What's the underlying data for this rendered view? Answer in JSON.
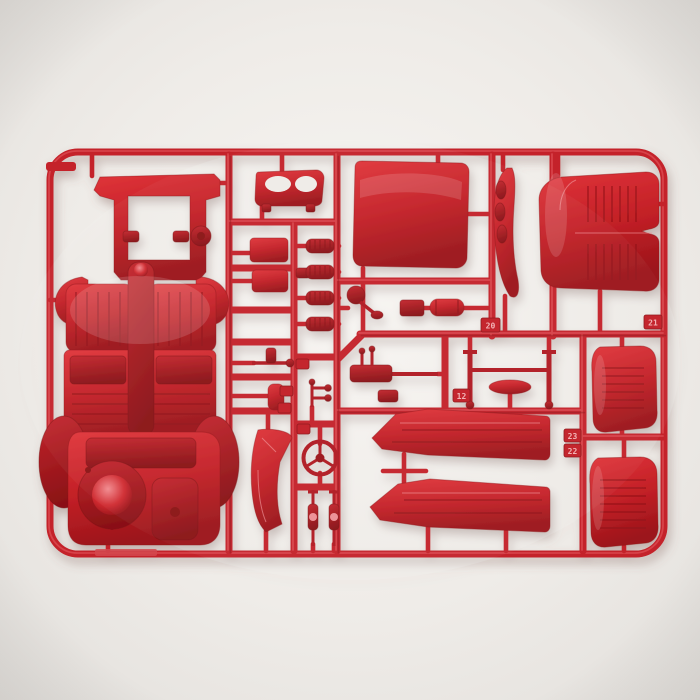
{
  "scene": {
    "type": "photograph",
    "subject": "Red plastic model-kit sprue (parts runner) with car model parts",
    "background_color": "#eae7e3",
    "plastic_color": "#c4222a",
    "plastic_dark": "#8e1217",
    "plastic_highlight": "#ef8e92"
  },
  "tags": {
    "t20": "20",
    "t21": "21",
    "t12": "12",
    "t23": "23",
    "t22": "22"
  },
  "parts": {
    "chassis": "chassis floor pan with seats and spare-wheel well",
    "dashboard": "dashboard panel with two oval recesses",
    "roof_panel": "large square roof panel",
    "window_rail": "curved window rail",
    "bench_seat": "rear bench seat",
    "small_box_1": "small rectangular box",
    "small_box_2": "small rectangular box",
    "springs": "four coil springs",
    "mirror": "mirror with arm",
    "muffler": "muffler cylinder",
    "steering_gear": "steering gearbox and column",
    "axle": "axle posts with cross bar",
    "air_cleaner": "oval air-cleaner dish",
    "pedal_lever": "pedal lever",
    "small_plate": "small plate",
    "linkage": "linkage cluster",
    "a_pillar": "curved A-pillar trim",
    "steering_wheel": "three-spoke steering wheel",
    "dampers": "two shock absorbers",
    "rocker_upper": "upper rocker door panel",
    "rocker_lower": "lower rocker door panel",
    "bucket_seat_1": "bucket seat backrest (upper)",
    "bucket_seat_2": "bucket seat backrest (lower)"
  }
}
